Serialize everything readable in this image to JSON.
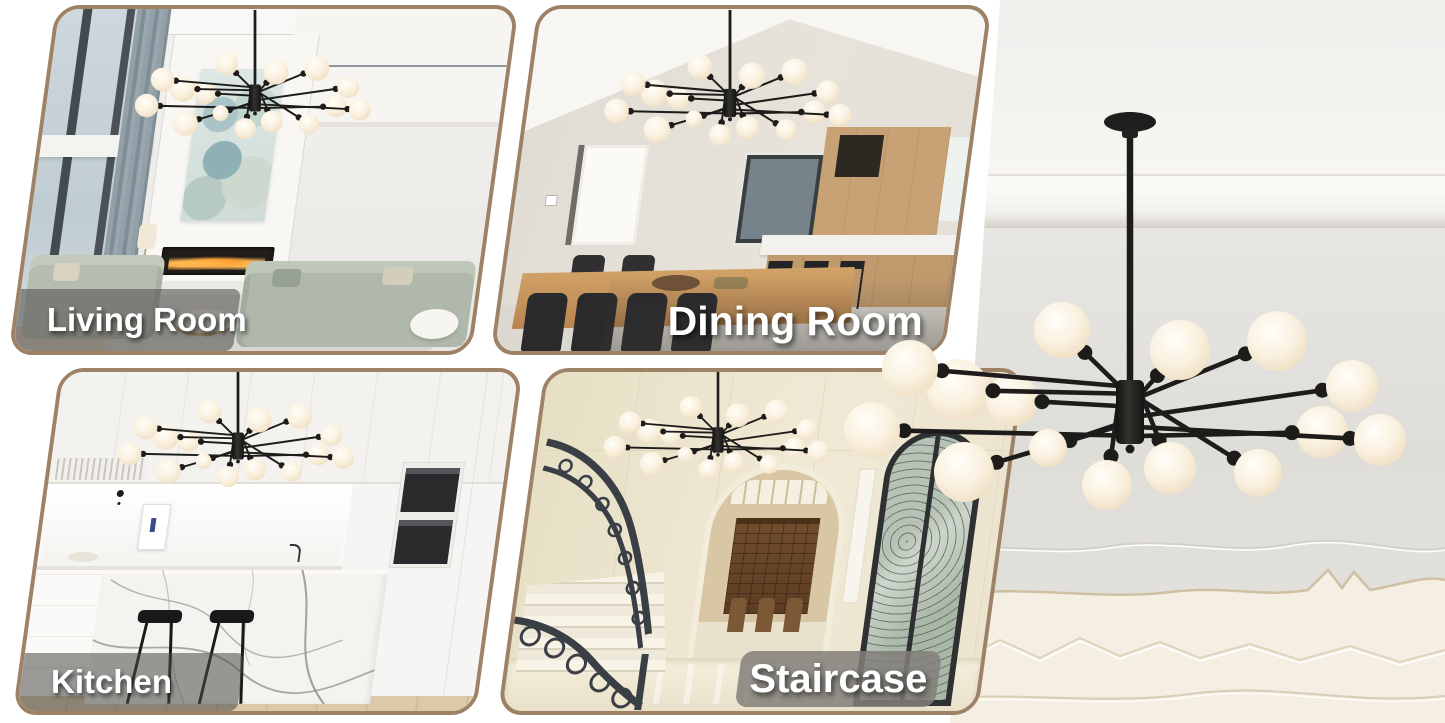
{
  "panels": [
    {
      "id": "living-room",
      "label": "Living Room"
    },
    {
      "id": "dining-room",
      "label": "Dining Room"
    },
    {
      "id": "kitchen",
      "label": "Kitchen"
    },
    {
      "id": "staircase",
      "label": "Staircase"
    }
  ],
  "product": {
    "description": "modern black sputnik chandelier with frosted white glass globes",
    "visible_globe_count": 15,
    "colors": {
      "fixture": "#1d1c1a",
      "globes": "#f8efdd"
    }
  },
  "style": {
    "panel_border": "#9d8266",
    "label_text_color": "#ffffff",
    "label_band": "rgba(75,73,70,0.55)",
    "staircase_band": "rgba(130,127,122,0.85)",
    "background": "#ffffff"
  }
}
